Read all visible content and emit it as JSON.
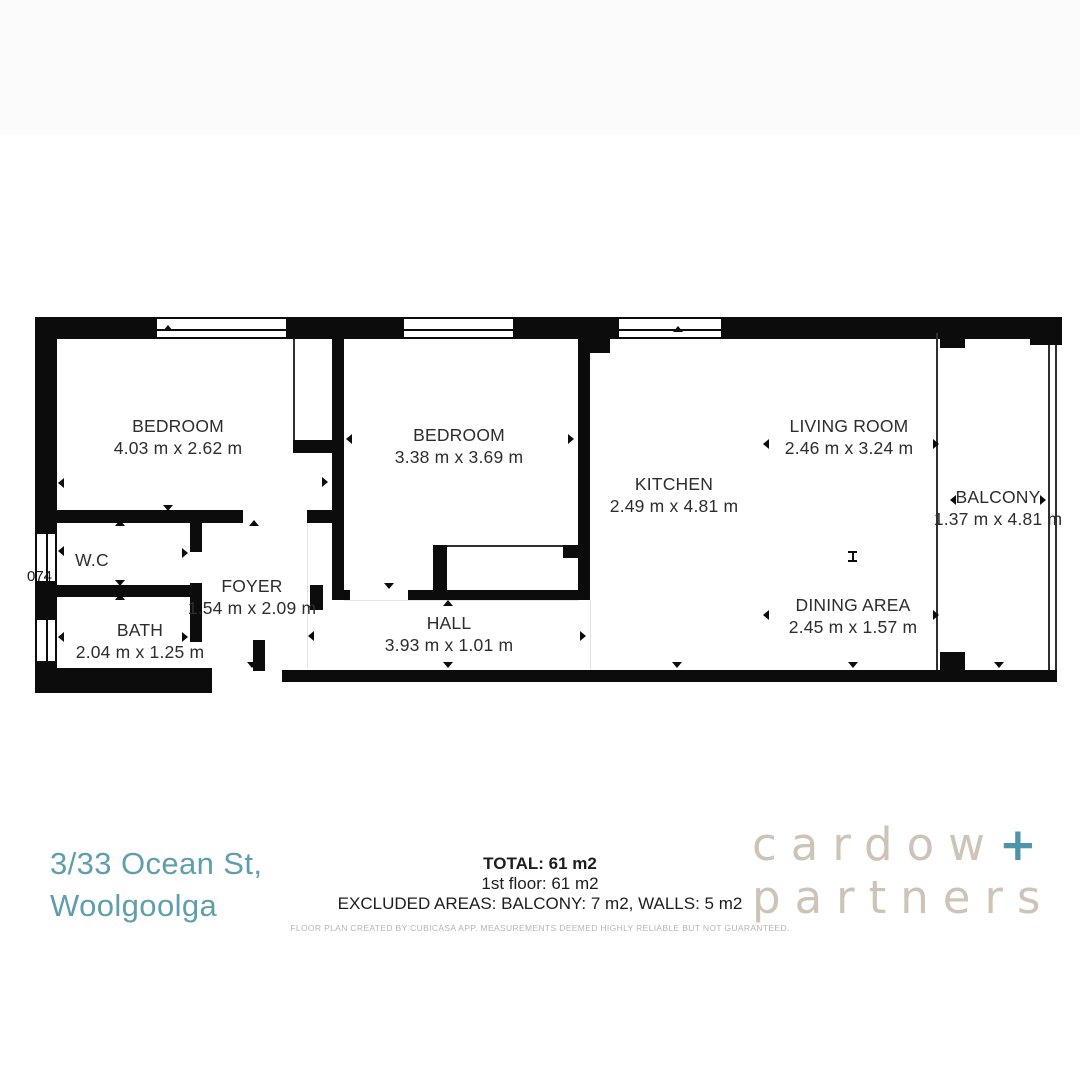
{
  "floorplan": {
    "rooms": [
      {
        "id": "bedroom-1",
        "name": "BEDROOM",
        "dims": "4.03 m x 2.62 m"
      },
      {
        "id": "bedroom-2",
        "name": "BEDROOM",
        "dims": "3.38 m x 3.69 m"
      },
      {
        "id": "kitchen",
        "name": "KITCHEN",
        "dims": "2.49 m x 4.81 m"
      },
      {
        "id": "living-room",
        "name": "LIVING ROOM",
        "dims": "2.46 m x 3.24 m"
      },
      {
        "id": "balcony",
        "name": "BALCONY",
        "dims": "1.37 m x 4.81 m"
      },
      {
        "id": "dining-area",
        "name": "DINING AREA",
        "dims": "2.45 m x 1.57 m"
      },
      {
        "id": "wc",
        "name": "W.C",
        "dims": ""
      },
      {
        "id": "foyer",
        "name": "FOYER",
        "dims": "1.54 m x 2.09 m"
      },
      {
        "id": "bath",
        "name": "BATH",
        "dims": "2.04 m x 1.25 m"
      },
      {
        "id": "hall",
        "name": "HALL",
        "dims": "3.93 m x 1.01 m"
      }
    ],
    "edge_label": "074",
    "wall_color": "#0c0c0c"
  },
  "footer": {
    "address_line1": "3/33 Ocean St,",
    "address_line2": "Woolgoolga",
    "address_color": "#5e9ead",
    "total": "TOTAL: 61 m2",
    "floor": "1st floor: 61 m2",
    "excluded": "EXCLUDED AREAS: BALCONY: 7 m2, WALLS: 5 m2",
    "disclaimer": "FLOOR PLAN CREATED BY CUBICASA APP. MEASUREMENTS DEEMED HIGHLY RELIABLE BUT NOT GUARANTEED."
  },
  "logo": {
    "word1": "cardow",
    "plus": "+",
    "word2": "partners",
    "color": "#cdc3b6",
    "plus_color": "#4e95a9"
  }
}
